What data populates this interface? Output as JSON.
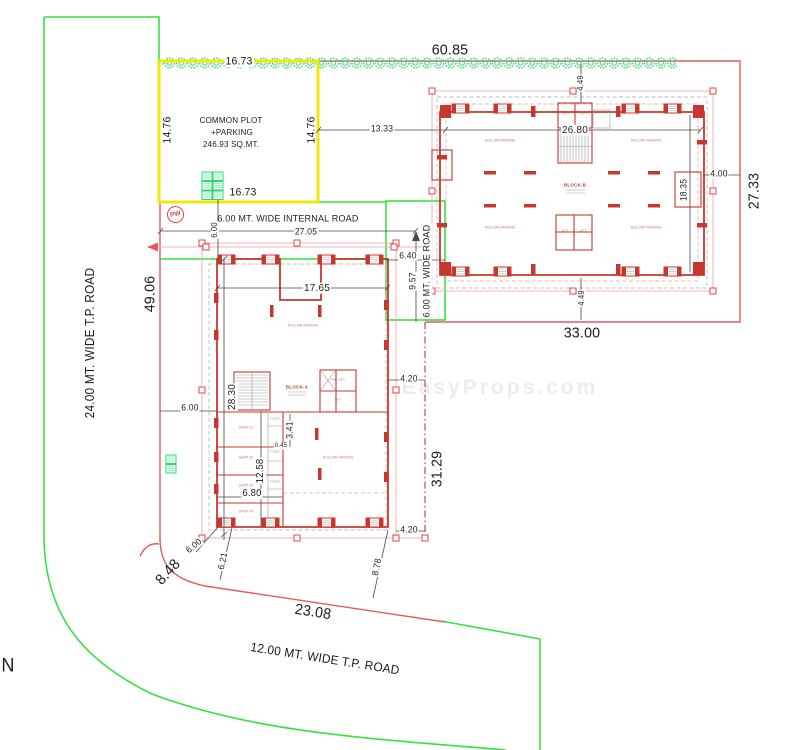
{
  "colors": {
    "boundary_green": "#35e23f",
    "tree_green": "#2fd573",
    "plot_yellow": "#f4e609",
    "wall_red": "#c8372d",
    "dim_red_line": "#e25c5c",
    "selection_pink": "#f2b0b0",
    "dim_text": "#1c1c1c"
  },
  "labels": {
    "road_west": "24.00 MT. WIDE T.P. ROAD",
    "road_south": "12.00 MT. WIDE T.P. ROAD",
    "road_internal": "6.00 MT. WIDE INTERNAL ROAD",
    "road_east": "6.00 MT. WIDE ROAD",
    "north": "N",
    "pw": "PW",
    "watermark": "EasyProps.com",
    "common_plot": {
      "l1": "COMMON PLOT",
      "l2": "+PARKING",
      "l3": "246.93 SQ.MT."
    }
  },
  "blocks": {
    "a_name": "BLOCK-A",
    "b_name": "BLOCK-B",
    "parking": "HOLLOW PARKING",
    "lift": "LIFT",
    "fire_lift": "FIRE LIFT",
    "toilet": "TOILET",
    "shop1": "SHOP 01",
    "shop2": "SHOP 02",
    "shop3": "SHOP 03",
    "shop4": "SHOP 04"
  },
  "dims": {
    "top_width": "60.85",
    "common_plot_top": "16.73",
    "common_plot_bottom": "16.73",
    "common_plot_left": "14.76",
    "common_plot_right": "14.76",
    "gap_13_33": "13.33",
    "block_b_width": "26.80",
    "block_b_setback_top": "4.49",
    "block_b_setback_bottom": "4.49",
    "block_b_bay": "18.35",
    "east_margin": "4.00",
    "east_boundary": "27.33",
    "south_b_width": "33.00",
    "internal_road_len": "27.05",
    "internal_road_width": "6.00",
    "west_boundary": "49.06",
    "road_east_width": "6.40",
    "road_east_len": "9.57",
    "block_a_width": "17.65",
    "block_a_height": "28.30",
    "west_margin": "6.00",
    "stair_3_41": "3.41",
    "wall_0_45": "0.45",
    "shops_12_58": "12.58",
    "shops_6_80": "6.80",
    "margin_4_20_mid": "4.20",
    "margin_4_20_low": "4.20",
    "plot_east_31_29": "31.29",
    "corner_6_00": "6.00",
    "corner_6_21": "6.21",
    "corner_8_78": "8.78",
    "corner_8_48": "8.48",
    "south_width_23_08": "23.08"
  }
}
